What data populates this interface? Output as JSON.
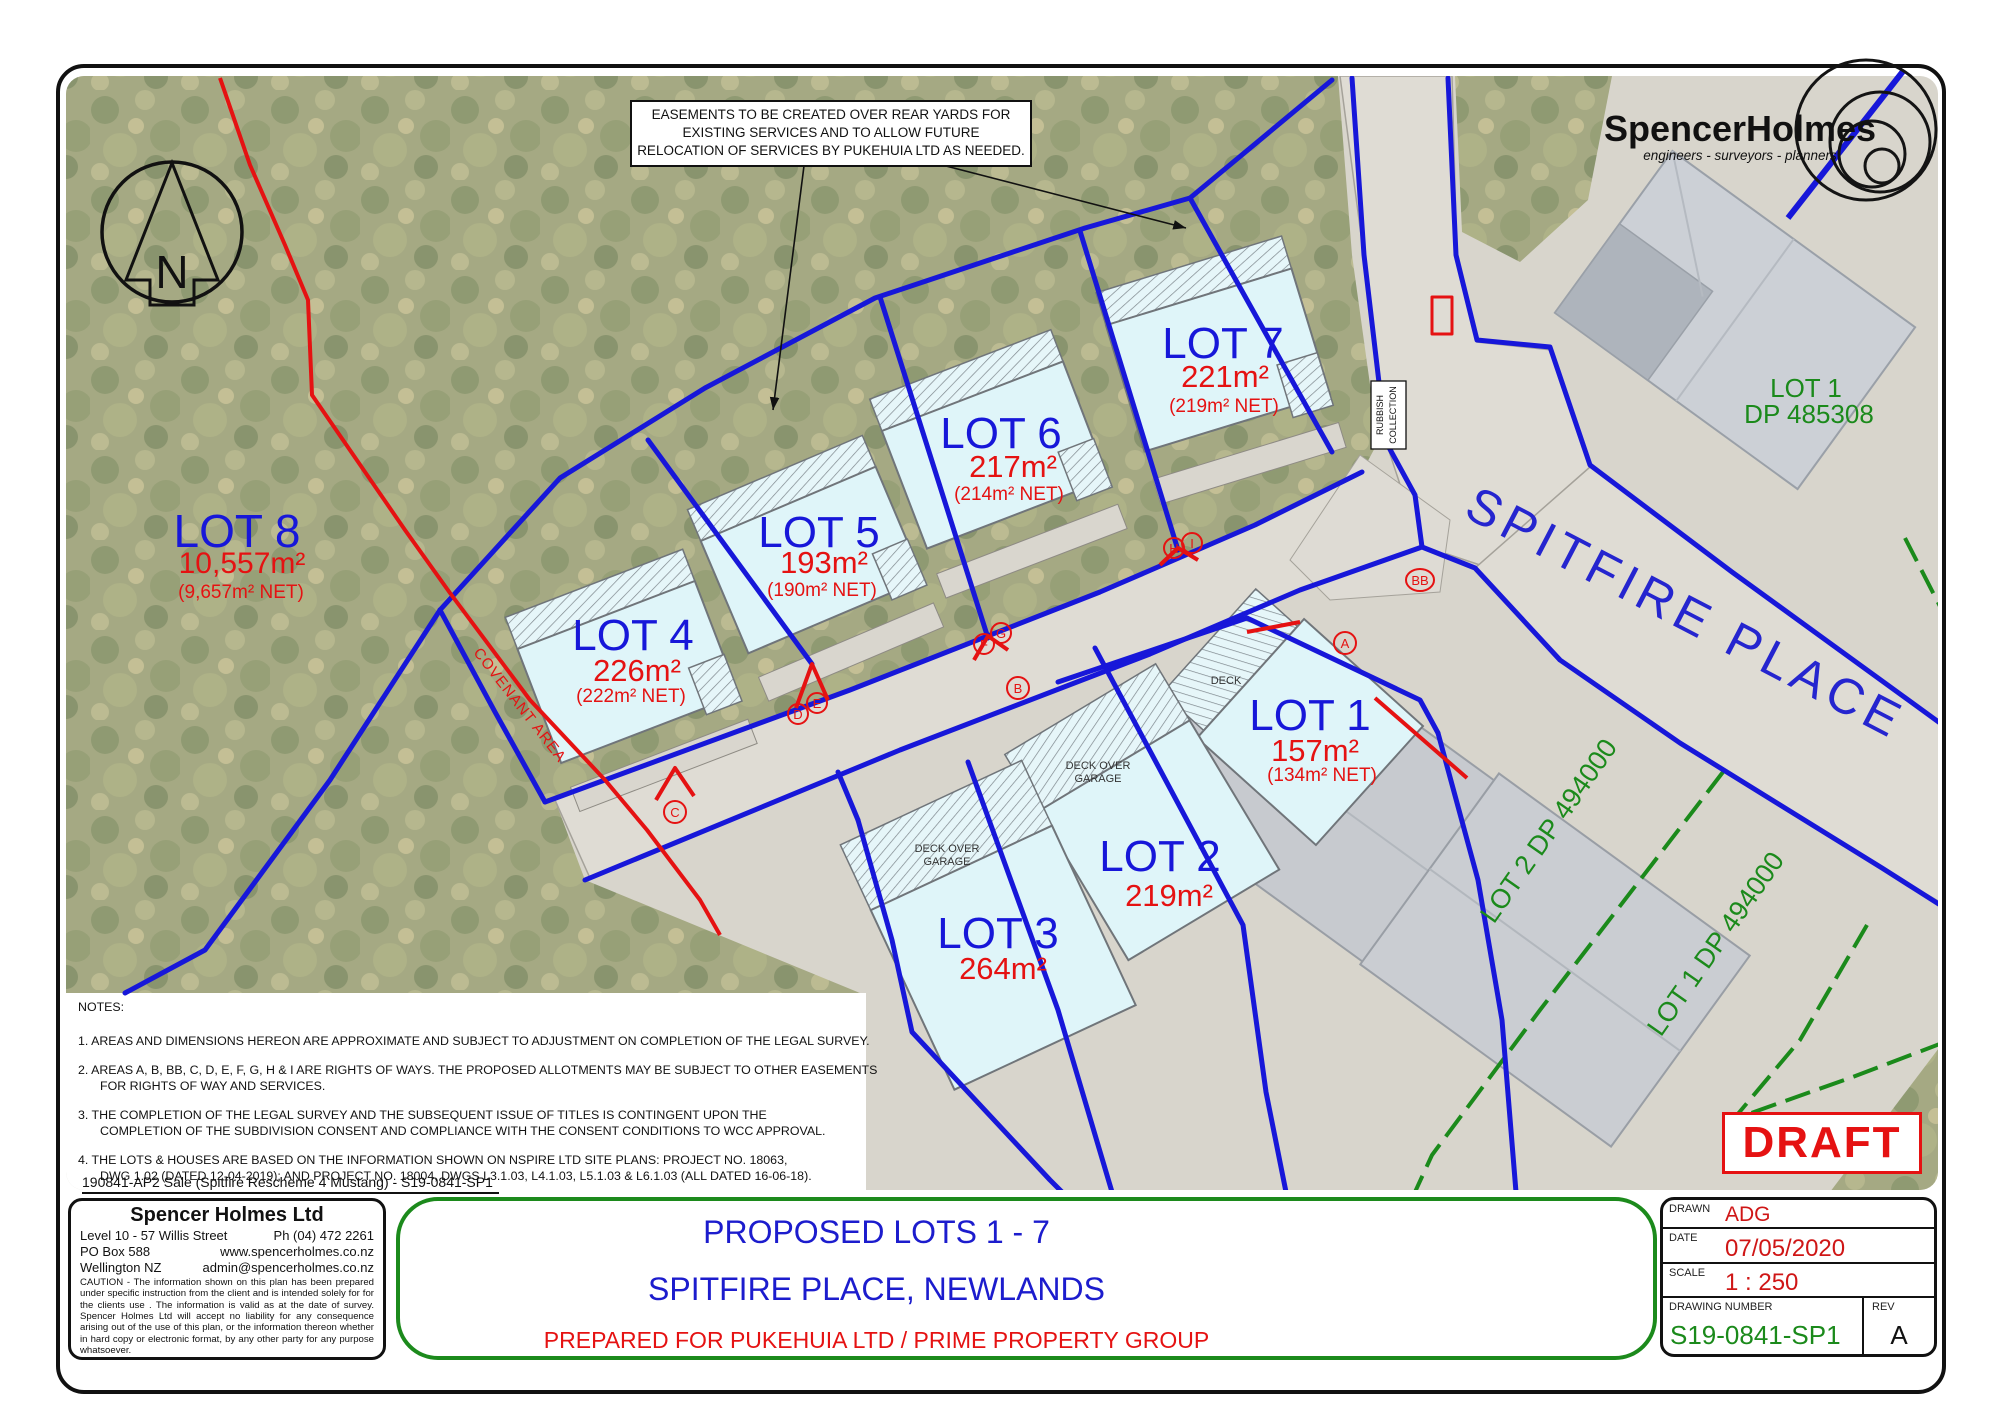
{
  "sheet": {
    "easement_note": {
      "l1": "EASEMENTS TO BE CREATED OVER REAR YARDS FOR",
      "l2": "EXISTING SERVICES AND TO ALLOW FUTURE",
      "l3": "RELOCATION OF SERVICES BY PUKEHUIA LTD AS NEEDED."
    },
    "logo": {
      "name": "SpencerHolmes",
      "tagline": "engineers - surveyors - planners"
    },
    "north_label": "N",
    "lots": {
      "lot8": {
        "label": "LOT 8",
        "area": "10,557m²",
        "net": "(9,657m² NET)"
      },
      "lot4": {
        "label": "LOT 4",
        "area": "226m²",
        "net": "(222m² NET)"
      },
      "lot5": {
        "label": "LOT 5",
        "area": "193m²",
        "net": "(190m² NET)"
      },
      "lot6": {
        "label": "LOT 6",
        "area": "217m²",
        "net": "(214m² NET)"
      },
      "lot7": {
        "label": "LOT 7",
        "area": "221m²",
        "net": "(219m² NET)"
      },
      "lot1": {
        "label": "LOT 1",
        "area": "157m²",
        "net": "(134m² NET)"
      },
      "lot2": {
        "label": "LOT 2",
        "area": "219m²"
      },
      "lot3": {
        "label": "LOT 3",
        "area": "264m²"
      }
    },
    "map_labels": {
      "street": "SPITFIRE PLACE",
      "covenant": "COVENANT AREA",
      "deck": "DECK",
      "deck_over": "DECK OVER",
      "garage": "GARAGE",
      "rubbish": "RUBBISH",
      "collection": "COLLECTION",
      "adj_lot1_line1": "LOT 1",
      "adj_lot1_line2": "DP 485308",
      "adj_lot2_dp": "LOT 2 DP 494000",
      "adj_lot1_dp": "LOT 1 DP 494000",
      "row_letters": [
        "A",
        "B",
        "BB",
        "C",
        "D",
        "E",
        "F",
        "G",
        "H",
        "I"
      ]
    },
    "notes": {
      "title": "NOTES:",
      "n1": "1.  AREAS AND DIMENSIONS HEREON ARE APPROXIMATE AND SUBJECT TO ADJUSTMENT ON COMPLETION OF THE LEGAL SURVEY.",
      "n2a": "2.  AREAS A, B, BB, C, D, E, F, G, H & I ARE RIGHTS OF WAYS.  THE PROPOSED ALLOTMENTS MAY BE SUBJECT TO OTHER EASEMENTS",
      "n2b": "FOR RIGHTS OF WAY AND SERVICES.",
      "n3a": "3.  THE COMPLETION OF THE LEGAL SURVEY AND THE SUBSEQUENT ISSUE OF TITLES IS CONTINGENT UPON THE",
      "n3b": "COMPLETION OF THE SUBDIVISION CONSENT AND COMPLIANCE WITH THE CONSENT CONDITIONS TO WCC APPROVAL.",
      "n4a": "4.  THE LOTS & HOUSES ARE BASED ON THE INFORMATION SHOWN ON NSPIRE LTD SITE PLANS: PROJECT NO. 18063,",
      "n4b": "DWG 1.02 (DATED 12-04-2019); AND PROJECT NO. 18004, DWGS L3.1.03, L4.1.03, L5.1.03 & L6.1.03 (ALL DATED 16-06-18)."
    },
    "file_ref": "190841-AP2 Sale (Spitfire Rescheme 4 Mustang) - S19-0841-SP1",
    "company": {
      "name": "Spencer Holmes Ltd",
      "addr1": "Level 10 - 57 Willis Street",
      "phone": "Ph  (04) 472 2261",
      "addr2": "PO Box 588",
      "web": "www.spencerholmes.co.nz",
      "addr3": "Wellington  NZ",
      "email": "admin@spencerholmes.co.nz",
      "caution": "CAUTION - The information shown on this plan has been prepared under specific instruction from the client and is intended solely for for the clients use . The information is valid as at the date of survey. Spencer Holmes Ltd will accept no liability for any consequence arising out of the use of this plan, or the information thereon whether in hard copy or electronic format, by any other party for any purpose whatsoever."
    },
    "titleblock": {
      "title1": "PROPOSED LOTS 1 - 7",
      "title2": "SPITFIRE PLACE, NEWLANDS",
      "title3": "PREPARED FOR PUKEHUIA LTD / PRIME PROPERTY GROUP",
      "drawn_label": "DRAWN",
      "drawn": "ADG",
      "date_label": "DATE",
      "date": "07/05/2020",
      "scale_label": "SCALE",
      "scale": "1 : 250",
      "dwg_label": "DRAWING NUMBER",
      "dwg": "S19-0841-SP1",
      "rev_label": "REV",
      "rev": "A",
      "draft": "DRAFT"
    },
    "colors": {
      "lot_blue": "#1717d9",
      "area_red": "#e51212",
      "dp_green": "#1b8a1b"
    }
  }
}
